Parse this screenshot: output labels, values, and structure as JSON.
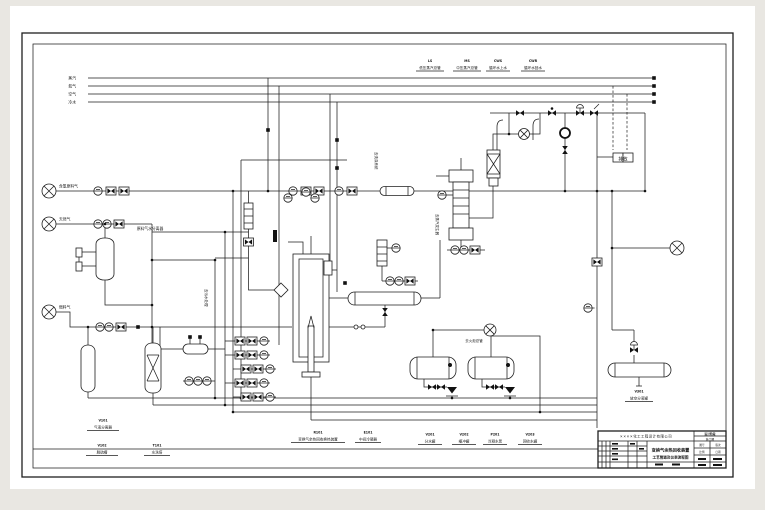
{
  "sheet": {
    "utility_headers": [
      "蒸汽",
      "氮气",
      "空气",
      "冷水"
    ],
    "header_streams": [
      {
        "tag": "LS",
        "name": "低压蒸汽总管"
      },
      {
        "tag": "MS",
        "name": "中压蒸汽总管"
      },
      {
        "tag": "CWS",
        "name": "循环水上水"
      },
      {
        "tag": "CWR",
        "name": "循环水回水"
      }
    ],
    "inlets": [
      "含氢原料气",
      "天然气",
      "燃料气"
    ],
    "annotations": {
      "separator_label": "原料气水分离器",
      "flare_label": "去火炬总管",
      "drain_label": "去污水处理",
      "steam_label": "去蒸汽发生器",
      "wash_label": "去洗涤系统",
      "vent_box": "排放"
    },
    "equipment_labels": [
      {
        "tag": "V101",
        "name": "气液分离器"
      },
      {
        "tag": "V102",
        "name": "脱硫槽"
      },
      {
        "tag": "T101",
        "name": "水洗塔"
      },
      {
        "tag": "R101",
        "name": "变换气余热回收换热装置"
      },
      {
        "tag": "E101",
        "name": "中间冷凝器"
      },
      {
        "tag": "V201",
        "name": "分水罐"
      },
      {
        "tag": "V202",
        "name": "缓冲罐"
      },
      {
        "tag": "P201",
        "name": "冷凝水泵"
      },
      {
        "tag": "V203",
        "name": "回收水罐"
      },
      {
        "tag": "V301",
        "name": "放空分液罐"
      }
    ],
    "title_block": {
      "company": "××××化工工程设计有限公司",
      "title_line1": "变换气余热回收装置",
      "title_line2": "工艺管道及仪表流程图",
      "stage_label": "设计阶段",
      "stage_value": "施工图",
      "fields": [
        "图号",
        "版次",
        "比例",
        "日期"
      ]
    }
  }
}
